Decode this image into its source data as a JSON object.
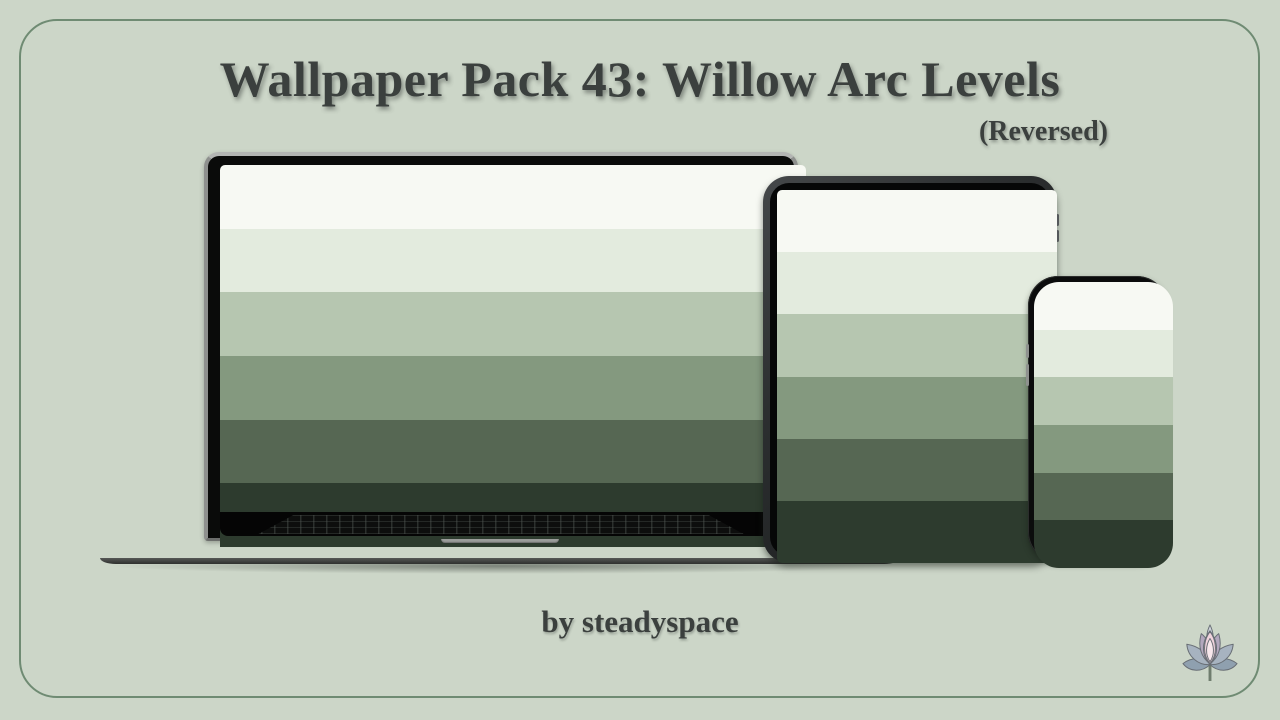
{
  "header": {
    "title": "Wallpaper Pack 43: Willow Arc Levels",
    "subtitle": "(Reversed)"
  },
  "footer": {
    "credit": "by steadyspace"
  },
  "branding": {
    "logo_icon": "lotus-flower"
  },
  "theme": {
    "background": "#ccd6c8",
    "border": "#6f8b73",
    "text": "#3b403e"
  },
  "wallpaper": {
    "name": "Willow Arc Levels (Reversed)",
    "stripe_count": 6,
    "stripe_colors": [
      "#f7f9f3",
      "#e3ebde",
      "#b6c6b0",
      "#84997f",
      "#566753",
      "#2d3b2e"
    ],
    "direction": "light-to-dark, top-to-bottom"
  },
  "devices": [
    {
      "type": "laptop"
    },
    {
      "type": "tablet"
    },
    {
      "type": "phone"
    }
  ]
}
